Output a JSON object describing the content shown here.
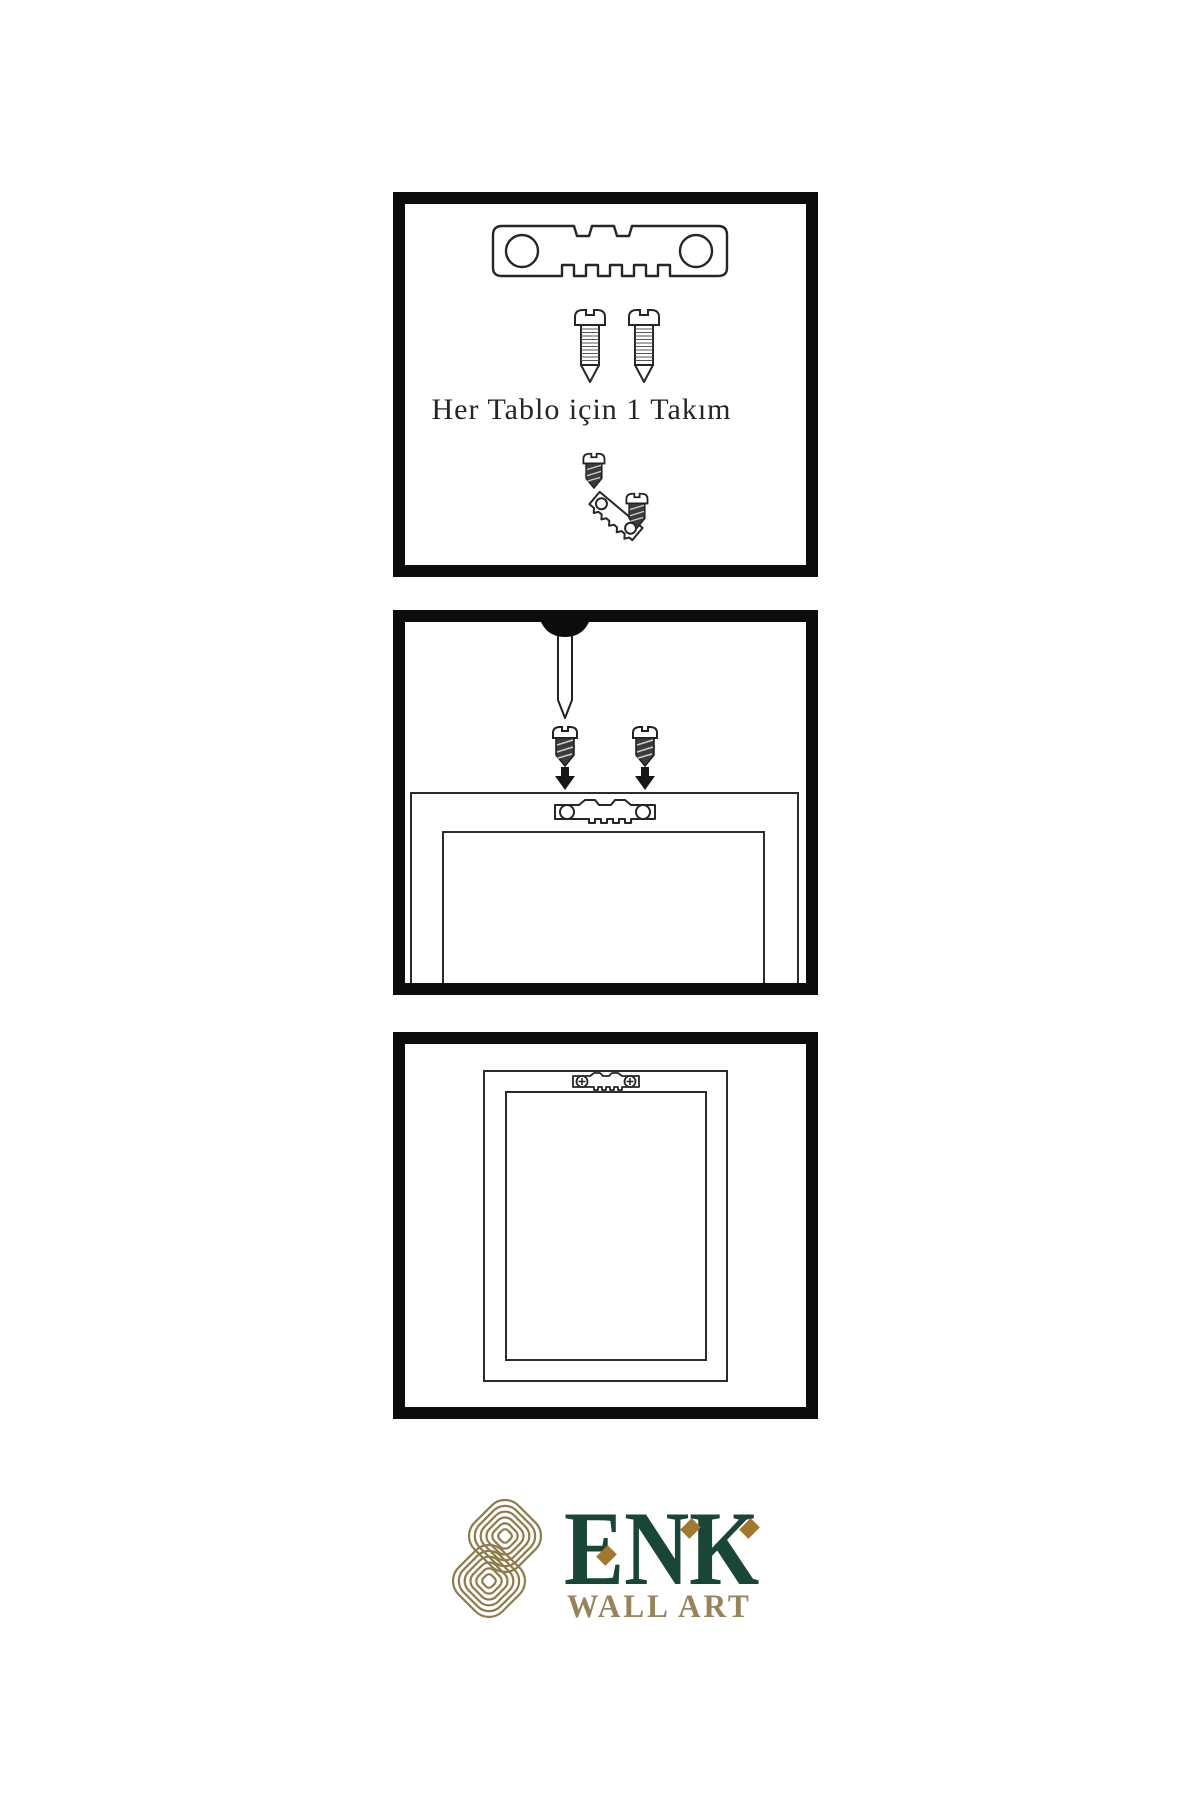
{
  "instructions": {
    "step1_label": "Her Tablo için 1 Takım"
  },
  "brand": {
    "name": "ENK",
    "tagline": "WALL ART",
    "colors": {
      "name_green": "#1a4639",
      "tagline_gold": "#96845a",
      "diamond_gold": "#a2772e",
      "knot_gold": "#8d7b4c"
    }
  },
  "illustration_line_color": "#262626",
  "panel_border_color": "#0c0c0c"
}
